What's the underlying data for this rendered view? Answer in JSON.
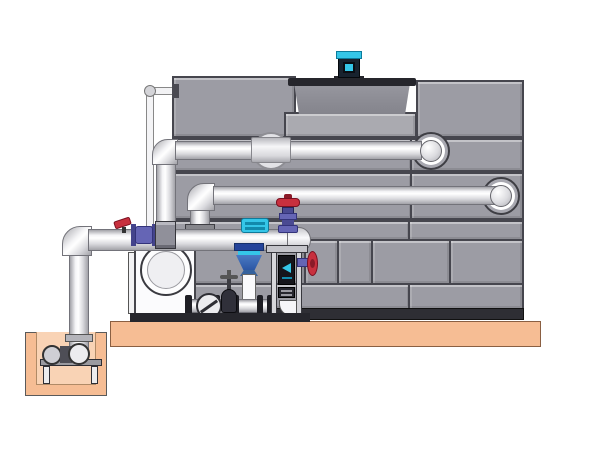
{
  "meta": {
    "title": "Cooling tower with external pump skid and sump — technical side-elevation illustration",
    "diagram_type": "industrial-equipment-rendering",
    "visible_text": "none"
  },
  "colors": {
    "background": "#ffffff",
    "panel": "#9c9ca4",
    "panel-seam": "#46464e",
    "ledge": "#aaaab0",
    "shroud-top": "#97979f",
    "shroud-bottom": "#84848c",
    "shroud-rim": "#26262c",
    "pipe-light": "#f4f4f6",
    "pipe-mid": "#d9d9dd",
    "pipe-dark": "#a2a2a8",
    "pipe-outline": "#73737a",
    "platform": "#f6bd94",
    "platform-light": "#f9d3b5",
    "platform-outline": "#8a5f42",
    "motor-body": "#18222e",
    "cyan": "#35c6e8",
    "cyan-dark": "#128aac",
    "red": "#c8303e",
    "red-dark": "#7a1020",
    "valve-purple": "#6565b5",
    "valve-purple-dark": "#33337a",
    "diffuser-blue": "#3a6cb4",
    "diffuser-blue-dark": "#16306a",
    "frame-panel": "#15151b",
    "steel-light": "#d6d6da",
    "skid-base": "#26262c",
    "tank-base": "#2e2e34"
  },
  "components": [
    {
      "name": "concrete-platform",
      "description": "tan equipment pad supporting tower and skid"
    },
    {
      "name": "sump-pit",
      "description": "tan below-grade pit at lower left with pump stand"
    },
    {
      "name": "pit-stand",
      "description": "small support table inside sump pit"
    },
    {
      "name": "pit-suction-elbow",
      "description": "suction pipe elbow and strainer balls in pit"
    },
    {
      "name": "cooling-tower-casing",
      "description": "gray paneled tower body with brick-pattern lower panels"
    },
    {
      "name": "fan-shroud",
      "description": "dark tapered fan cylinder recessed in tower top"
    },
    {
      "name": "fan-motor",
      "description": "black motor with cyan cap and window on shroud"
    },
    {
      "name": "overflow-pipe",
      "description": "thin white standpipe on left face of tower"
    },
    {
      "name": "upper-return-pipe",
      "description": "upper horizontal pipe entering tower through flanged nozzle"
    },
    {
      "name": "mid-return-pipe",
      "description": "second horizontal pipe entering tower lower right"
    },
    {
      "name": "inline-coupling",
      "description": "cylindrical coupling with backing flange on upper pipe"
    },
    {
      "name": "suction-header",
      "description": "horizontal header pipe above pump skid"
    },
    {
      "name": "suction-riser",
      "description": "vertical pipe from sump pit up to header"
    },
    {
      "name": "drain-ball-valve",
      "description": "small red-lever valve on header"
    },
    {
      "name": "butterfly-valve",
      "description": "purple wafer valve on header"
    },
    {
      "name": "flow-switch",
      "description": "cyan instrument mounted on header"
    },
    {
      "name": "globe-valve",
      "description": "red-handwheel purple-bodied valve on header end"
    },
    {
      "name": "suction-diffuser",
      "description": "blue cone fitting below header feeding drop pipe"
    },
    {
      "name": "centrifugal-pump",
      "description": "white end-suction pump with large inlet eye"
    },
    {
      "name": "sight-glass-check",
      "description": "round check/sight fitting on skid piping"
    },
    {
      "name": "gate-valve-small",
      "description": "small cross-handle valve on skid piping"
    },
    {
      "name": "instrument-frame",
      "description": "steel channel frame with dark control panels and drain elbow"
    },
    {
      "name": "side-handwheel-valve",
      "description": "red handwheel valve projecting right from frame"
    },
    {
      "name": "skid-base-rail",
      "description": "dark base rail under pump skid"
    }
  ]
}
